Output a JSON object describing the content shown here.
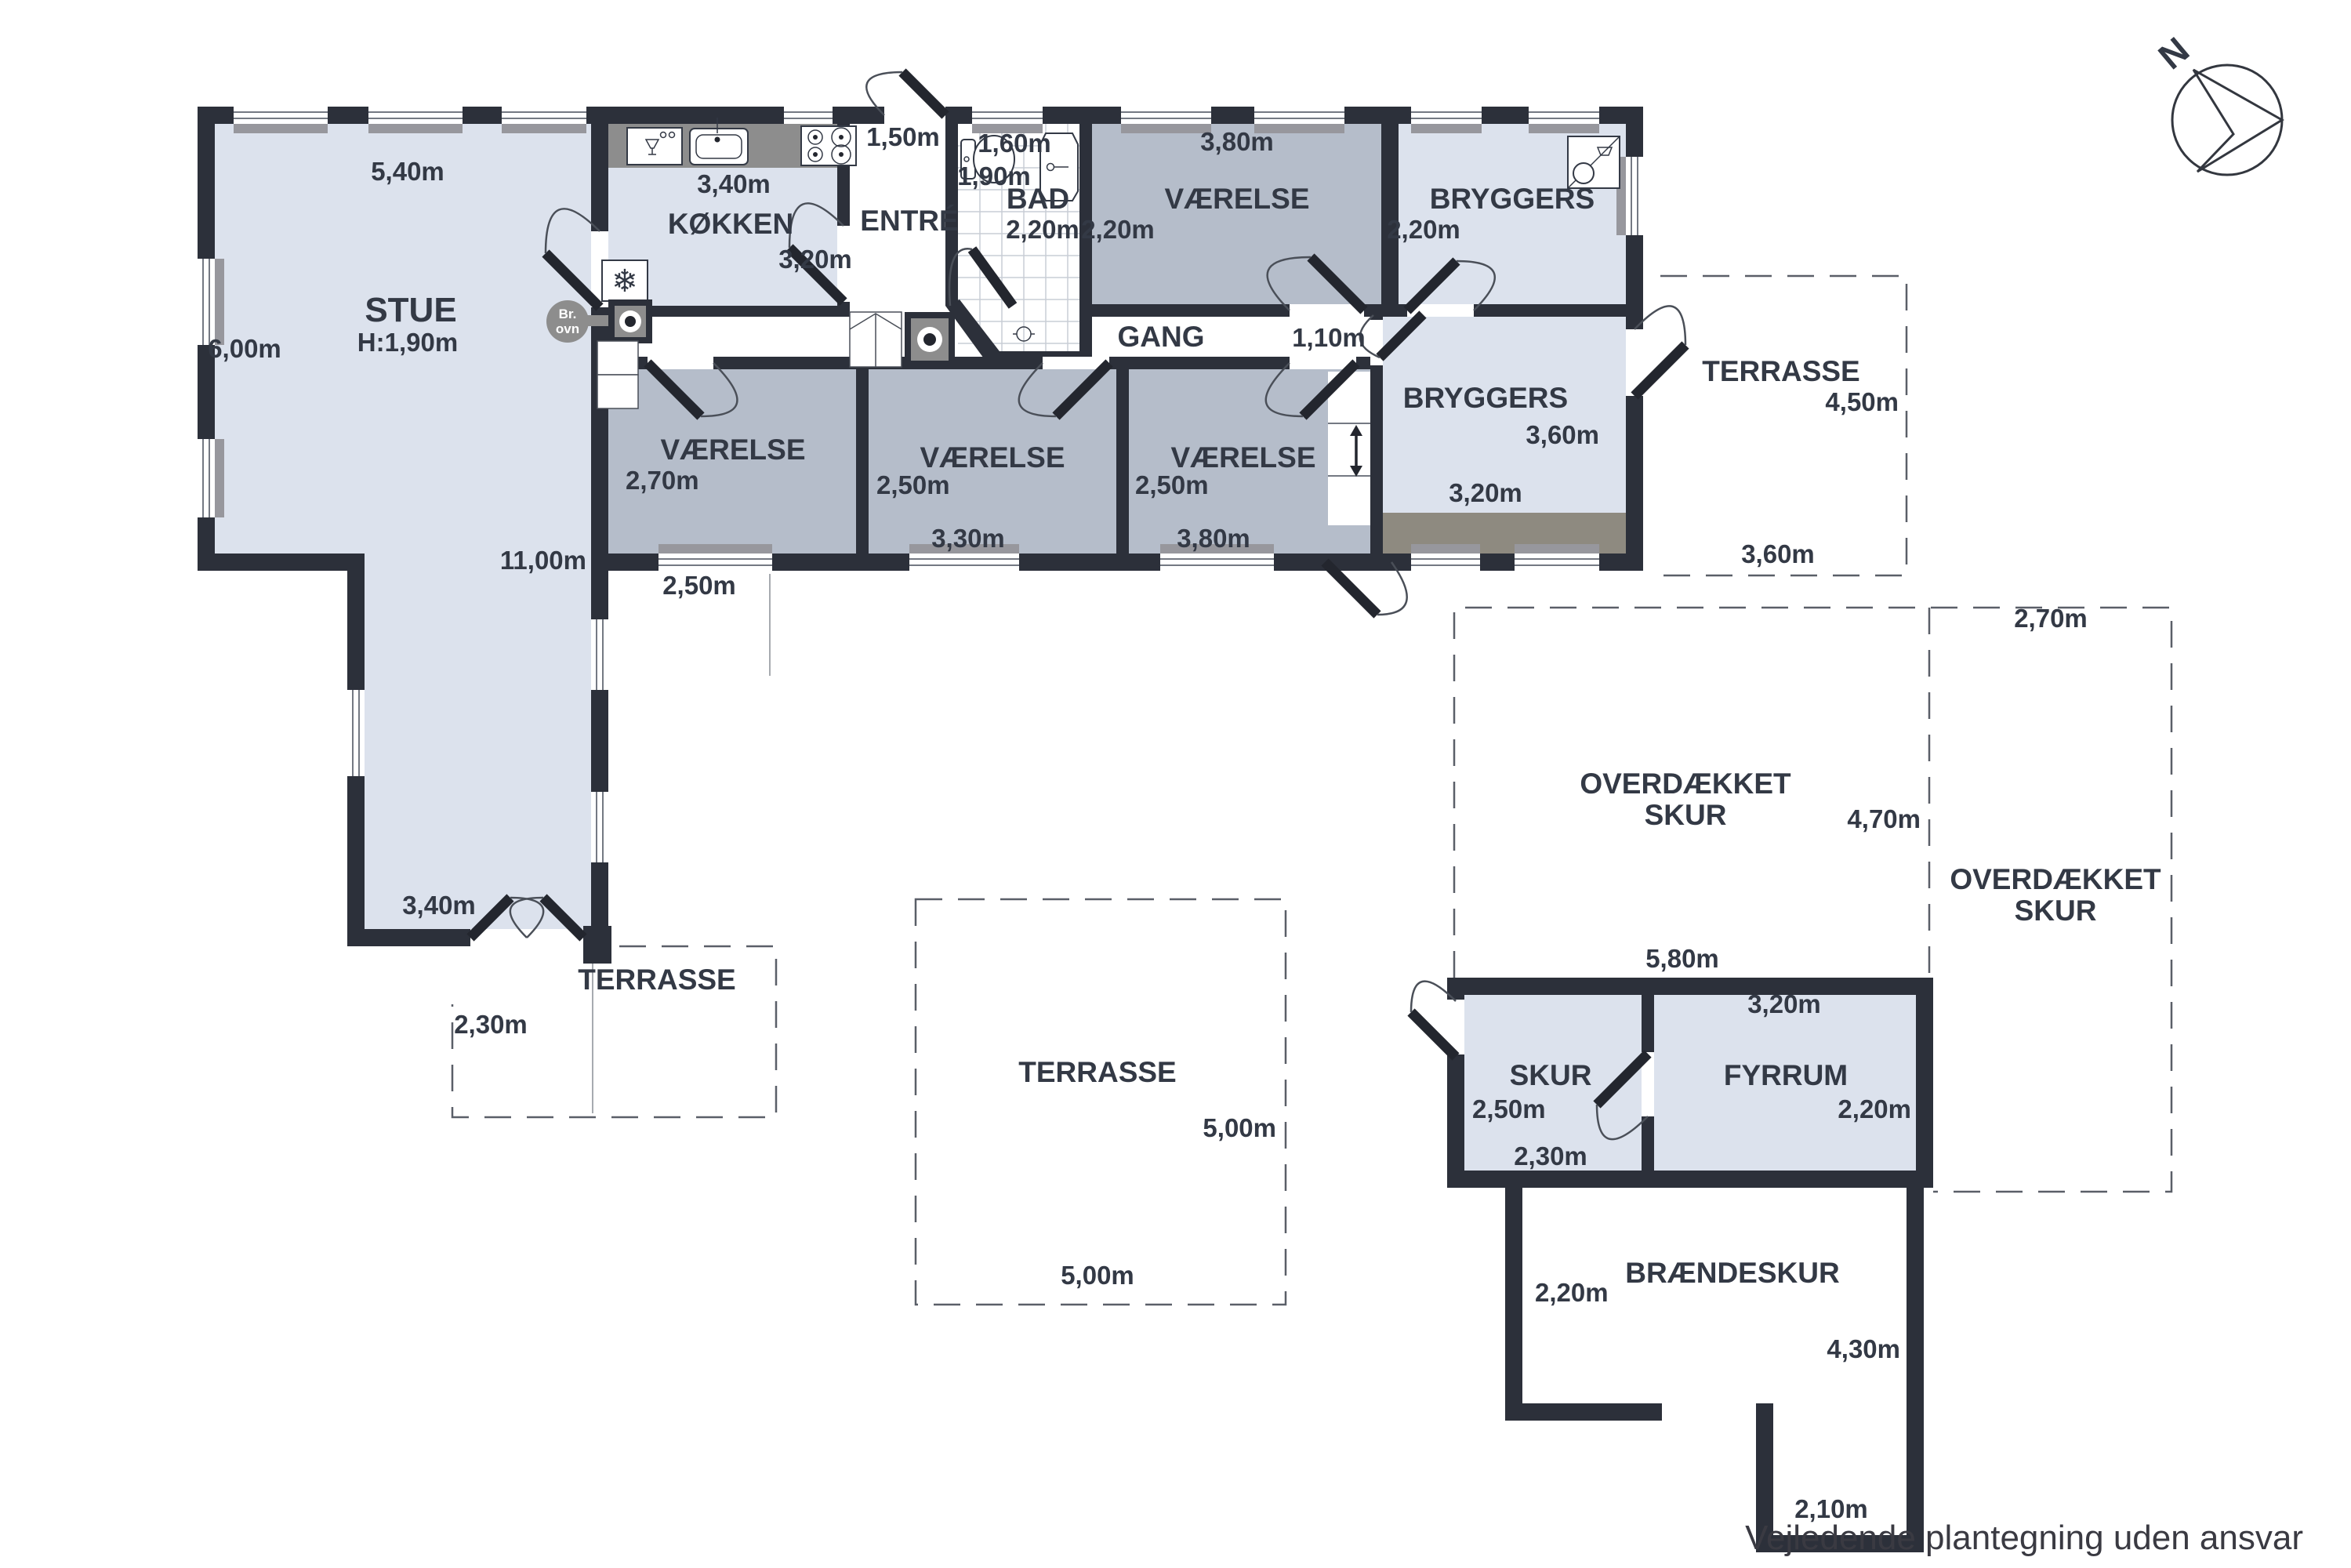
{
  "plan": {
    "rooms": {
      "stue": {
        "name": "STUE",
        "ceiling_height": "H:1,90m",
        "dim_width": "5,40m",
        "dim_height": "6,00m",
        "dim_inner_length": "11,00m",
        "dim_leg_width": "3,40m"
      },
      "kokken": {
        "name": "KØKKEN",
        "dim_width": "3,40m",
        "dim_height": "3,20m"
      },
      "entre": {
        "name": "ENTRÉ",
        "dim_entry": "1,50m"
      },
      "bad": {
        "name": "BAD",
        "dim_width": "1,60m",
        "dim_lower_width": "1,90m",
        "dim_height": "2,20m"
      },
      "vaerelse_top": {
        "name": "VÆRELSE",
        "dim_width": "3,80m",
        "dim_height": "2,20m"
      },
      "bryggers_top": {
        "name": "BRYGGERS",
        "dim_height": "2,20m"
      },
      "gang": {
        "name": "GANG",
        "dim_width": "1,10m"
      },
      "bryggers_east": {
        "name": "BRYGGERS",
        "dim_height": "3,60m",
        "dim_width": "3,20m"
      },
      "vaerelse_a": {
        "name": "VÆRELSE",
        "dim_height": "2,70m",
        "dim_window": "2,50m"
      },
      "vaerelse_b": {
        "name": "VÆRELSE",
        "dim_height": "2,50m",
        "dim_width": "3,30m"
      },
      "vaerelse_c": {
        "name": "VÆRELSE",
        "dim_height": "2,50m",
        "dim_width": "3,80m"
      },
      "skur": {
        "name": "SKUR",
        "dim_height": "2,50m",
        "dim_width": "2,30m",
        "dim_building_width": "5,80m"
      },
      "fyrrum": {
        "name": "FYRRUM",
        "dim_width": "3,20m",
        "dim_height": "2,20m"
      },
      "braendeskur": {
        "name": "BRÆNDESKUR",
        "dim_left": "2,20m",
        "dim_right": "4,30m",
        "dim_opening": "2,10m"
      },
      "terrasse_west": {
        "name": "TERRASSE",
        "dim": "2,30m"
      },
      "terrasse_south": {
        "name": "TERRASSE",
        "dim_height": "5,00m",
        "dim_width": "5,00m"
      },
      "terrasse_east": {
        "name": "TERRASSE",
        "dim_height": "4,50m",
        "dim_width": "3,60m"
      },
      "overdaekket_skur_west": {
        "name_line1": "OVERDÆKKET",
        "name_line2": "SKUR",
        "dim_height": "4,70m"
      },
      "overdaekket_skur_east": {
        "name_line1": "OVERDÆKKET",
        "name_line2": "SKUR",
        "dim_width": "2,70m"
      }
    },
    "icons": {
      "freezer_glyph": "❄",
      "wood_stove_label_line1": "Br.",
      "wood_stove_label_line2": "ovn"
    },
    "compass": {
      "north_label": "N"
    },
    "footer": {
      "disclaimer": "Vejledende plantegning uden ansvar"
    },
    "colors": {
      "wall": "#2c303a",
      "floor_light": "#dce2ed",
      "floor_medium": "#b5bdca",
      "counter_gray": "#8d8d8d",
      "text": "#333945"
    }
  }
}
